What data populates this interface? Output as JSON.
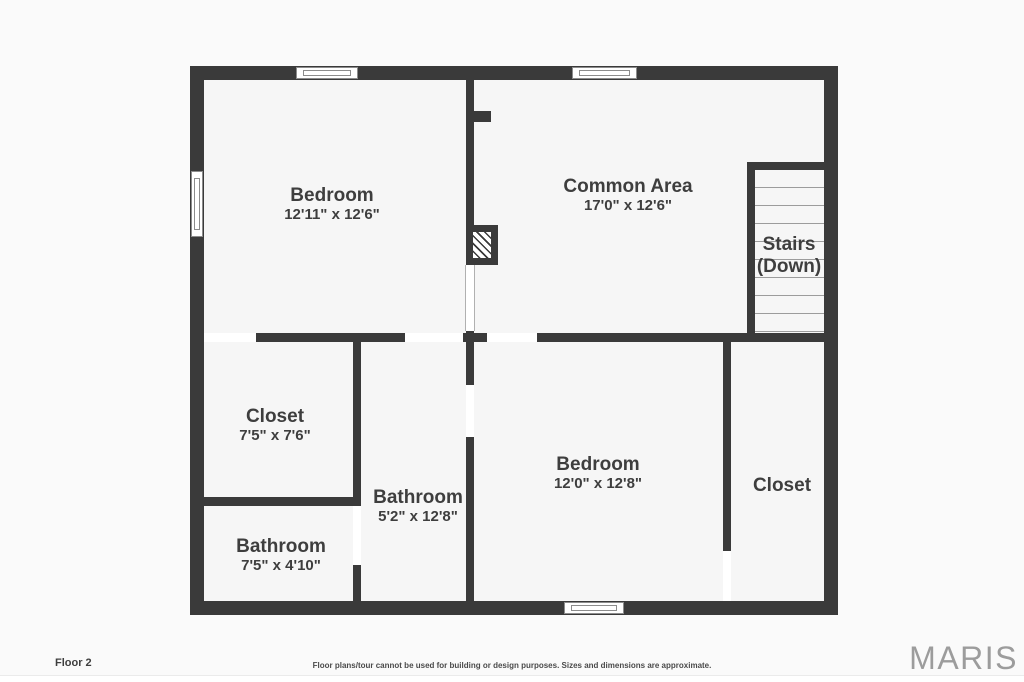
{
  "title": "Floor 2 floor plan",
  "plan": {
    "rooms": [
      {
        "name": "Bedroom",
        "dims": "12'11\" x 12'6\""
      },
      {
        "name": "Common Area",
        "dims": "17'0\" x 12'6\""
      },
      {
        "name": "Closet",
        "dims": "7'5\" x 7'6\""
      },
      {
        "name": "Bathroom",
        "dims": "5'2\" x 12'8\""
      },
      {
        "name": "Bathroom",
        "dims": "7'5\" x 4'10\""
      },
      {
        "name": "Bedroom",
        "dims": "12'0\" x 12'8\""
      },
      {
        "name": "Closet"
      }
    ],
    "stairs": {
      "line1": "Stairs",
      "line2": "(Down)"
    }
  },
  "footer": {
    "floor_label": "Floor 2",
    "disclaimer": "Floor plans/tour cannot be used for building or design purposes. Sizes and dimensions are approximate.",
    "brand": "MARIS"
  },
  "colors": {
    "bg": "#fafafa",
    "room": "#f6f6f6",
    "wall": "#3a3a3a",
    "text": "#3e3e3e",
    "window_border": "#8c8c8c",
    "tread": "#9c9c9c",
    "brand": "#9c9c9c",
    "disclaimer": "#4a4a4a"
  }
}
